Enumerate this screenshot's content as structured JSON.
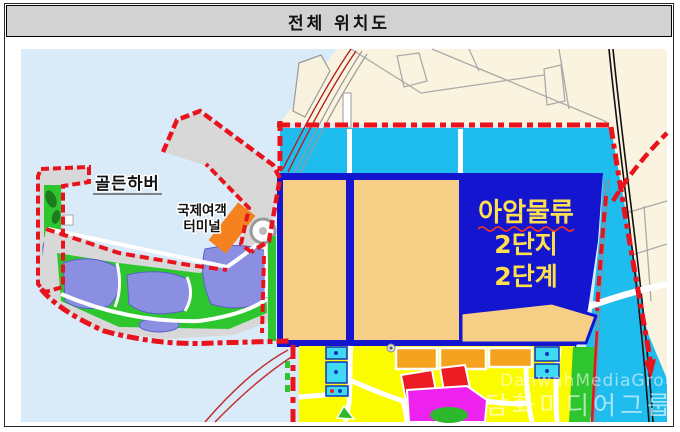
{
  "title": "전체 위치도",
  "map": {
    "labels": {
      "golden_harbor": "골든하버",
      "intl_passenger_terminal": {
        "line1": "국제여객",
        "line2": "터미널"
      },
      "aam_logistics": {
        "line1": "아암물류",
        "line2": "2단지",
        "line3": "2단계"
      }
    },
    "watermark": {
      "latin": "DanwahMediaGroup",
      "korean": "담화미디어그룹"
    },
    "colors": {
      "sea": "#D9EBF8",
      "urban_land": "#FAF3DF",
      "harbor_water": "#1FBCEE",
      "logistics_site": "#1316CE",
      "reclaimed_parcel": "#F6CE86",
      "city_blocks": "#FCFC00",
      "commercial_parcel": "#F5A31F",
      "red_parcel": "#ED1C24",
      "magenta_parcel": "#EE22EE",
      "park_green": "#2EC62E",
      "marina_water": "#8B8FE2",
      "pier_gray": "#D8D8D8",
      "terminal_orange": "#F5821F",
      "boundary_red": "#E8131C",
      "label_yellow": "#FFDF4D"
    }
  }
}
